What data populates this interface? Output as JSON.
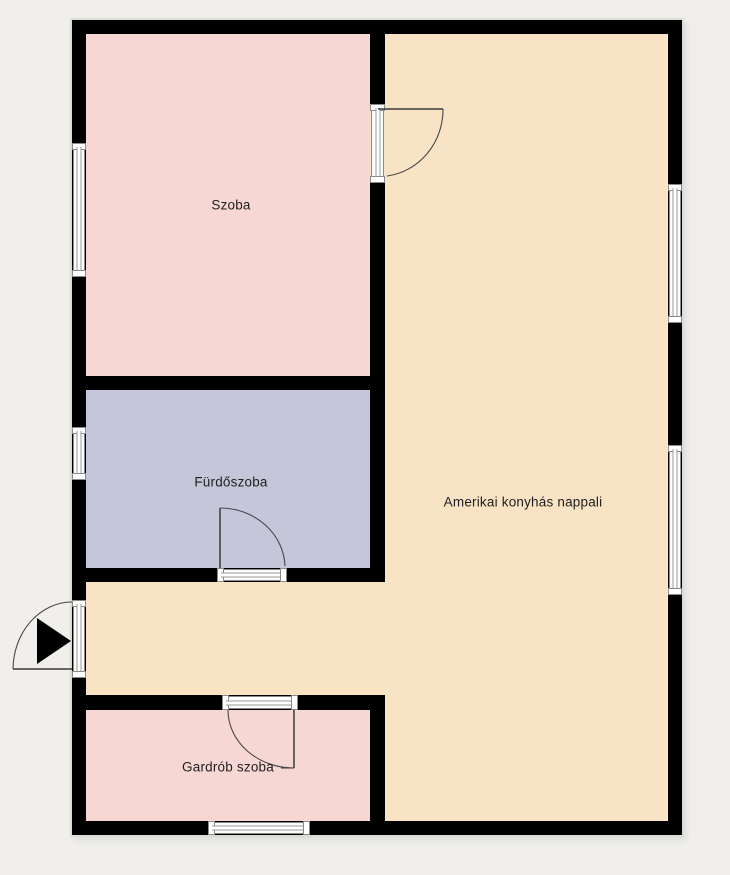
{
  "plan": {
    "background_color": "#f0efec",
    "wall_color": "#000000",
    "rooms": [
      {
        "id": "szoba",
        "label": "Szoba",
        "color": "#f7d7d3"
      },
      {
        "id": "furdoszoba",
        "label": "Fürdőszoba",
        "color": "#c5c6da"
      },
      {
        "id": "nappali",
        "label": "Amerikai konyhás nappali",
        "color": "#f8e3c4"
      },
      {
        "id": "gardrob",
        "label": "Gardrób szoba",
        "color": "#f7d7d3"
      }
    ],
    "entrance": {
      "icon": "entrance-arrow-icon",
      "direction": "right"
    }
  }
}
